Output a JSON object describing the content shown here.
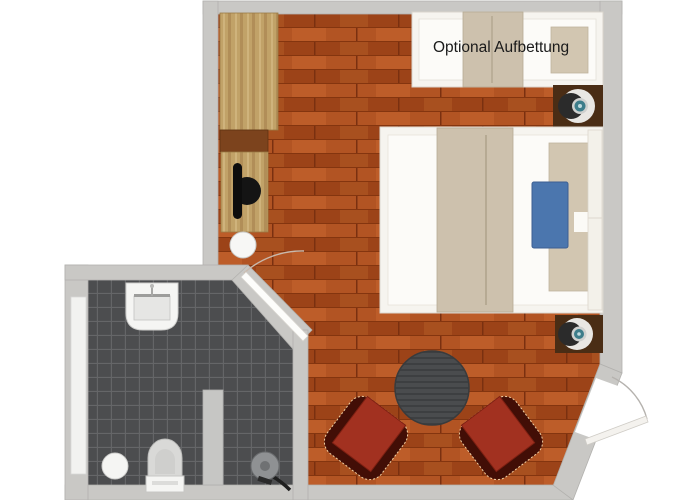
{
  "plan": {
    "type": "hotel-room-floor-plan",
    "rooms": [
      {
        "name": "bedroom",
        "floor": "wood-parquet"
      },
      {
        "name": "bathroom",
        "floor": "dark-tile"
      }
    ],
    "furniture": [
      "wardrobe",
      "desk",
      "office-chair",
      "stool",
      "sofa-daybed",
      "double-bed",
      "nightstand-top",
      "nightstand-bottom",
      "bedside-lamp",
      "round-table",
      "armchair-left",
      "armchair-right",
      "sink",
      "toilet",
      "shower",
      "waste-bin",
      "radiator",
      "partition-wall",
      "bathroom-door",
      "entry-door"
    ]
  },
  "labels": {
    "optional_bed": "Optional Aufbettung"
  },
  "colors": {
    "wall": "#c9c8c5",
    "wall_edge": "#b2b1ae",
    "wood_base": "#a84b1d",
    "tile_base": "#4c4d4f",
    "wardrobe": "#c1a268",
    "shelf": "#7c431d",
    "bed_frame": "#f6f4ef",
    "mattress": "#fcfbf8",
    "blanket": "#cdc1ad",
    "pillow": "#d2c6b1",
    "blue_cushion": "#4b76ae",
    "nightstand": "#4a2d15",
    "lamp_teal": "#3d7d8a",
    "chair_seat": "#a23120",
    "chair_back": "#420e06",
    "chair_trim": "#f0cfa3",
    "table": "#4a4c4e",
    "fixture_white": "#f5f5f3",
    "shower_gray": "#8f9193",
    "office_chair_black": "#141414",
    "label_color": "#1a1a1a"
  }
}
